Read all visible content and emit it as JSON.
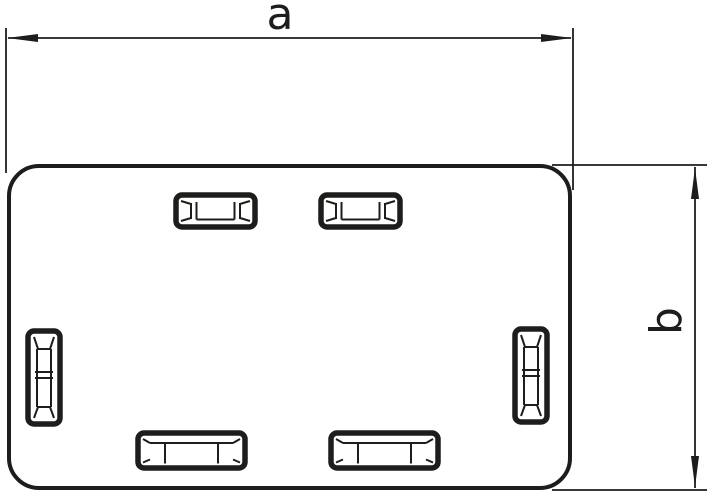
{
  "drawing": {
    "type": "technical-dimension-drawing",
    "labels": {
      "dim_width": "a",
      "dim_height": "b"
    },
    "figure": {
      "body": "rounded-rectangle end piece outline",
      "slots": [
        "latch-slot-top-left",
        "latch-slot-top-right",
        "latch-slot-left",
        "latch-slot-right",
        "latch-slot-bottom-left",
        "latch-slot-bottom-right"
      ]
    },
    "colors": {
      "line": "#1d1d1b",
      "background": "#ffffff"
    }
  }
}
